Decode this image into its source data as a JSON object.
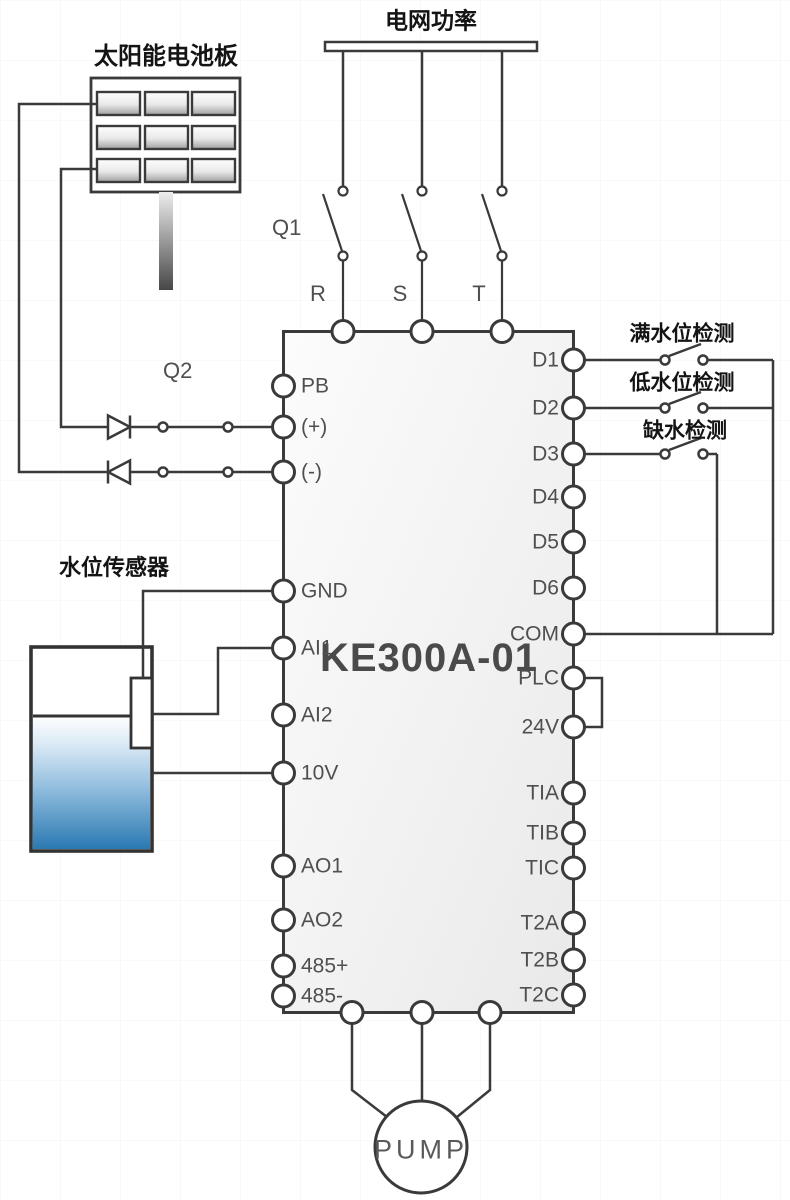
{
  "device": {
    "model": "KE300A-01"
  },
  "labels": {
    "grid_power": "电网功率",
    "solar_panel": "太阳能电池板",
    "water_sensor": "水位传感器",
    "breaker_q1": "Q1",
    "switch_q2": "Q2",
    "full_water_detect": "满水位检测",
    "low_water_detect": "低水位检测",
    "water_shortage_detect": "缺水检测",
    "pump": "PUMP"
  },
  "phase_labels": [
    "R",
    "S",
    "T"
  ],
  "terminals": {
    "left": [
      "PB",
      "(+)",
      "(-)",
      "GND",
      "AI1",
      "AI2",
      "10V",
      "AO1",
      "AO2",
      "485+",
      "485-"
    ],
    "right": [
      "D1",
      "D2",
      "D3",
      "D4",
      "D5",
      "D6",
      "COM",
      "PLC",
      "24V",
      "TIA",
      "TIB",
      "TIC",
      "T2A",
      "T2B",
      "T2C"
    ]
  },
  "colors": {
    "wire": "#3a3a3a",
    "terminal_fill": "#ffffff",
    "label_text": "#4f4f4f",
    "chinese_text": "#141414",
    "water_deep": "#2a79b2",
    "block_fill": "#ededed"
  }
}
